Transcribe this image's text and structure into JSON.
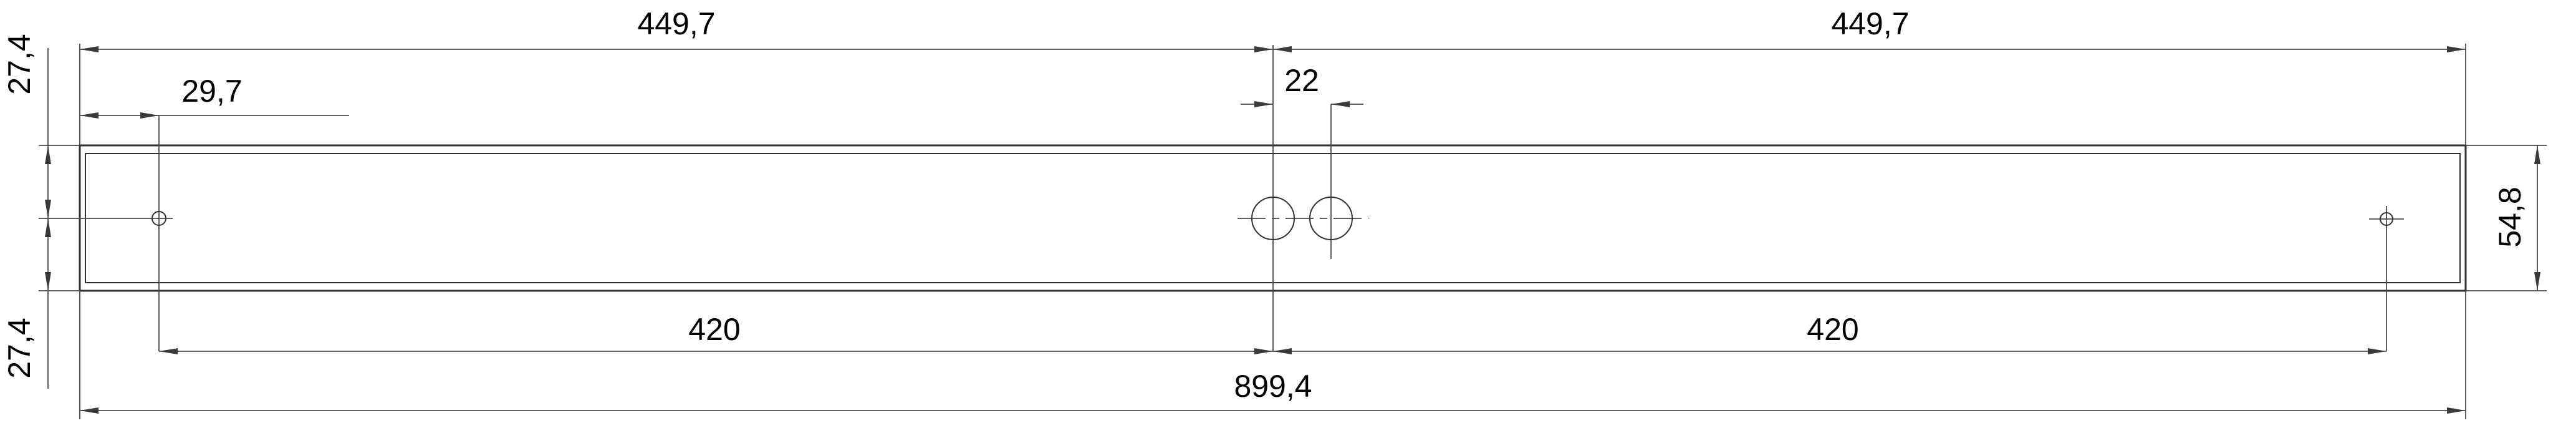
{
  "drawing": {
    "type": "technical-dimension-drawing",
    "units_style": "comma-decimal",
    "colors": {
      "background": "#ffffff",
      "outline": "#2f2f2f",
      "dimension_lines": "#4a4a4a",
      "text": "#000000"
    },
    "dimensions": {
      "top_left_span": "449,7",
      "top_right_span": "449,7",
      "left_edge_to_hole_top": "27,4",
      "left_edge_to_hole_bottom": "27,4",
      "left_hole_offset": "29,7",
      "center_hole_spacing": "22",
      "bottom_left_span": "420",
      "bottom_right_span": "420",
      "overall_length": "899,4",
      "profile_height": "54,8"
    }
  }
}
